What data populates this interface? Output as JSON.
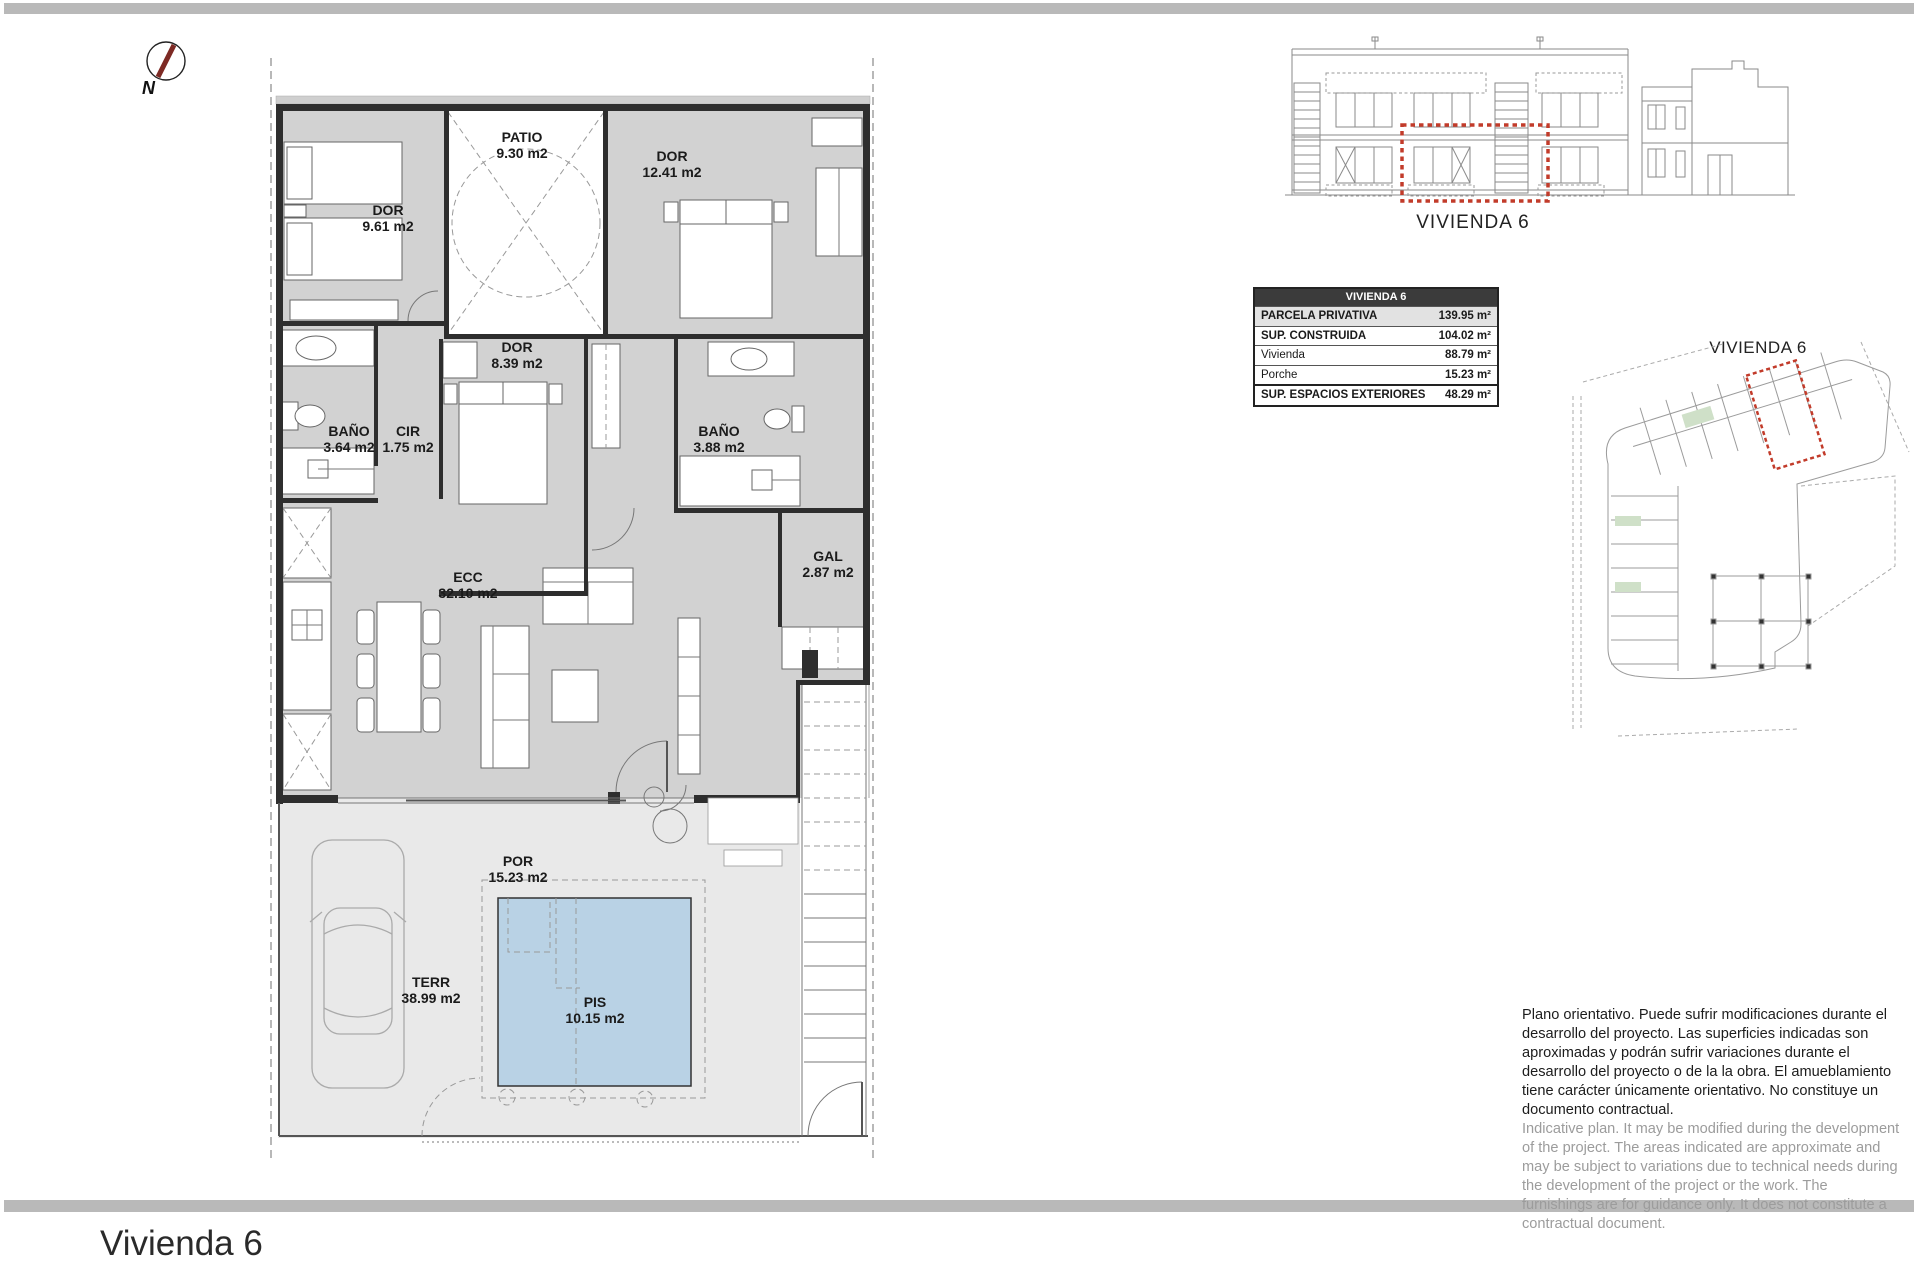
{
  "north": {
    "label": "N"
  },
  "plan": {
    "rooms": [
      {
        "name": "DOR",
        "area": "9.61 m2"
      },
      {
        "name": "PATIO",
        "area": "9.30 m2"
      },
      {
        "name": "DOR",
        "area": "12.41 m2"
      },
      {
        "name": "BAÑO",
        "area": "3.64 m2"
      },
      {
        "name": "CIR",
        "area": "1.75 m2"
      },
      {
        "name": "DOR",
        "area": "8.39 m2"
      },
      {
        "name": "BAÑO",
        "area": "3.88 m2"
      },
      {
        "name": "GAL",
        "area": "2.87 m2"
      },
      {
        "name": "ECC",
        "area": "32.10 m2"
      },
      {
        "name": "POR",
        "area": "15.23 m2"
      },
      {
        "name": "TERR",
        "area": "38.99 m2"
      },
      {
        "name": "PIS",
        "area": "10.15 m2"
      }
    ]
  },
  "elevation": {
    "caption": "VIVIENDA 6"
  },
  "siteplan": {
    "caption": "VIVIENDA 6"
  },
  "areas_table": {
    "header": "VIVIENDA 6",
    "rows": [
      {
        "label": "PARCELA PRIVATIVA",
        "value": "139.95 m²"
      },
      {
        "label": "SUP. CONSTRUIDA",
        "value": "104.02 m²"
      },
      {
        "label": "Vivienda",
        "value": "88.79 m²"
      },
      {
        "label": "Porche",
        "value": "15.23 m²"
      },
      {
        "label": "SUP. ESPACIOS EXTERIORES",
        "value": "48.29 m²"
      }
    ]
  },
  "disclaimer": {
    "spanish": "Plano orientativo. Puede sufrir modificaciones durante el desarrollo del proyecto. Las superficies indicadas son aproximadas y podrán sufrir variaciones durante el desarrollo del proyecto o de la la obra. El amueblamiento tiene carácter únicamente orientativo. No constituye un documento contractual.",
    "english": "Indicative plan. It may be modified during the development of the project. The areas indicated are approximate and may be subject to variations due to technical needs during the development of the project or the work. The furnishings are for guidance only. It does not constitute a contractual document."
  },
  "footer": {
    "title": "Vivienda 6"
  }
}
